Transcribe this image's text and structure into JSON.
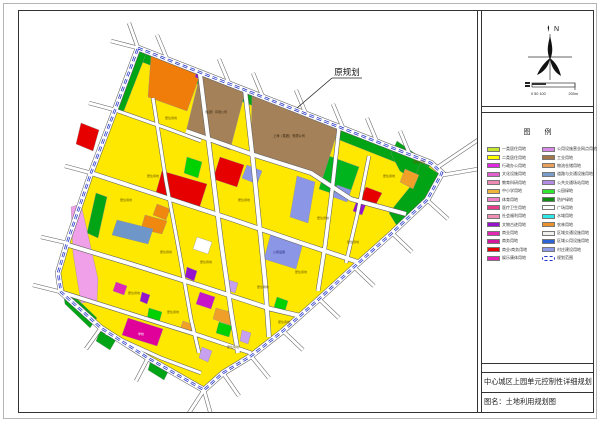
{
  "north_panel": {
    "north_label": "N",
    "scale_ticks": "0 50 100",
    "scale_end": "200m"
  },
  "legend": {
    "title": "图  例",
    "items": [
      {
        "color": "#c3e82e",
        "label": "一类居住用地"
      },
      {
        "color": "#ffff00",
        "label": "二类居住用地"
      },
      {
        "color": "#e028e0",
        "label": "行政办公用地"
      },
      {
        "color": "#e060d0",
        "label": "文化设施用地"
      },
      {
        "color": "#f08cb4",
        "label": "教育科研用地"
      },
      {
        "color": "#f0b43c",
        "label": "中小学用地"
      },
      {
        "color": "#f080c8",
        "label": "体育用地"
      },
      {
        "color": "#e63c8c",
        "label": "医疗卫生用地"
      },
      {
        "color": "#f090b4",
        "label": "社会福利用地"
      },
      {
        "color": "#9612cd",
        "label": "文物古迹用地"
      },
      {
        "color": "#e02ab4",
        "label": "商业用地"
      },
      {
        "color": "#d4189e",
        "label": "商务用地"
      },
      {
        "color": "#e60000",
        "label": "商业/商务用地"
      },
      {
        "color": "#eb1eb4",
        "label": "娱乐康体用地"
      },
      {
        "color": "#d98ae8",
        "label": "公用设施营业网点用地"
      },
      {
        "color": "#a5764a",
        "label": "工业用地"
      },
      {
        "color": "#e8a05a",
        "label": "物流仓储用地"
      },
      {
        "color": "#7a9cc8",
        "label": "道路与交通设施用地"
      },
      {
        "color": "#b48ce8",
        "label": "公共交通场站用地"
      },
      {
        "color": "#2ee82e",
        "label": "公园绿地"
      },
      {
        "color": "#0f8c0f",
        "label": "防护绿地"
      },
      {
        "color": "#ffffff",
        "label": "广场用地"
      },
      {
        "color": "#2ee8e8",
        "label": "水域用地"
      },
      {
        "color": "#e8922e",
        "label": "农林用地"
      },
      {
        "color": "#f0f0ee",
        "label": "区域交通设施用地"
      },
      {
        "color": "#2a64d4",
        "label": "区域公用设施用地"
      },
      {
        "color": "#8c9ce8",
        "label": "村庄建设用地"
      },
      {
        "boundary": true,
        "color": "#2030c8",
        "label": "规划范围"
      }
    ]
  },
  "title_block": {
    "line1": "中心城区上园单元控制性详细规划",
    "line2": "图名：土地利用规划图"
  },
  "map": {
    "annotation": {
      "text": "原规划",
      "tx": 346,
      "ty": 74,
      "underline": "331,77 361,77",
      "leader": "331,77 296,107"
    },
    "base_fill": "#ffe800",
    "boundary": {
      "color": "#2030c8",
      "points": "137,47 430,162 441,172 426,199 391,232 353,266 318,298 282,330 250,355 222,372 203,389 147,357 100,327 60,291 57,272 66,242 90,172 114,109"
    },
    "parcels": [
      {
        "p": "141,51 427,163 422,172 136,59",
        "f": "#00a414"
      },
      {
        "p": "137,50 145,53 122,112 114,108",
        "f": "#00a414"
      },
      {
        "p": "396,140 429,163 423,186 399,170 390,153",
        "f": "#00a414"
      },
      {
        "p": "420,161 438,173 424,197 396,225 388,212 409,186",
        "f": "#00a414"
      },
      {
        "p": "328,155 358,166 347,198 318,188",
        "f": "#00b41e"
      },
      {
        "p": "95,192 106,196 97,237 86,232",
        "f": "#00a414"
      },
      {
        "p": "62,291 73,295 96,317 89,327 64,303",
        "f": "#00a414"
      },
      {
        "p": "100,328 116,337 109,349 95,340",
        "f": "#00a414"
      },
      {
        "p": "150,358 169,367 163,379 147,369",
        "f": "#00a414"
      },
      {
        "p": "186,156 201,161 197,177 183,172",
        "f": "#00d200"
      },
      {
        "p": "148,307 161,311 158,322 146,318",
        "f": "#00d200"
      },
      {
        "p": "218,321 231,325 228,336 215,332",
        "f": "#00d200"
      },
      {
        "p": "276,296 287,300 284,310 273,306",
        "f": "#00d200"
      },
      {
        "p": "150,55 199,74 186,110 147,96",
        "f": "#f07d0a"
      },
      {
        "p": "199,74 244,91 229,149 185,131",
        "f": "#a5815a"
      },
      {
        "p": "251,92 338,126 322,176 285,163 250,150",
        "f": "#a5815a"
      },
      {
        "p": "144,214 166,220 161,233 140,228",
        "f": "#f0870f"
      },
      {
        "p": "156,203 169,208 165,219 152,214",
        "f": "#f0870f"
      },
      {
        "p": "404,168 418,174 412,188 399,181",
        "f": "#f0a028"
      },
      {
        "p": "215,307 233,312 229,324 212,318",
        "f": "#f0a028"
      },
      {
        "p": "182,320 193,324 190,333 179,329",
        "f": "#f0a028"
      },
      {
        "p": "80,122 98,129 92,150 75,143",
        "f": "#e60000"
      },
      {
        "p": "161,170 206,183 198,208 154,195",
        "f": "#e60000"
      },
      {
        "p": "219,156 243,164 236,186 212,178",
        "f": "#e60000"
      },
      {
        "p": "365,186 381,192 374,205 359,199",
        "f": "#e60000"
      },
      {
        "p": "246,164 261,170 256,183 241,177",
        "f": "#8c96e6"
      },
      {
        "p": "296,175 314,181 307,222 289,216",
        "f": "#8c96e6"
      },
      {
        "p": "270,232 302,242 295,268 263,258",
        "f": "#8c96e6"
      },
      {
        "p": "336,184 350,189 346,201 332,196",
        "f": "#8c96e6"
      },
      {
        "p": "116,219 152,228 147,243 111,234",
        "f": "#6e96c8"
      },
      {
        "p": "196,69 203,72 200,79 194,76",
        "f": "#9613cd"
      },
      {
        "p": "356,199 365,203 361,214 352,210",
        "f": "#9613cd"
      },
      {
        "p": "186,266 196,270 193,280 184,276",
        "f": "#9613cd"
      },
      {
        "p": "141,291 149,294 146,303 139,300",
        "f": "#9613cd"
      },
      {
        "p": "228,279 237,282 234,292 226,289",
        "f": "#c8a0f0"
      },
      {
        "p": "201,346 211,350 207,361 198,357",
        "f": "#c8a0f0"
      },
      {
        "p": "241,329 250,332 247,343 239,340",
        "f": "#c8a0f0"
      },
      {
        "p": "127,317 162,328 156,345 121,334",
        "f": "#e0009a"
      },
      {
        "p": "199,291 214,296 210,308 195,303",
        "f": "#c814c8"
      },
      {
        "p": "115,281 126,285 123,294 112,290",
        "f": "#e028b4"
      },
      {
        "p": "196,236 211,241 207,253 192,248",
        "f": "#ffffff"
      },
      {
        "p": "70,206 80,203 97,278 96,300 80,302 72,252",
        "f": "#f0a0e8"
      }
    ],
    "roads": [
      {
        "p": "152,97 165,180 178,250 190,318 198,352",
        "w": 3
      },
      {
        "p": "199,73 210,160 220,240 230,310 237,352",
        "w": 4
      },
      {
        "p": "244,89 252,160 258,220 264,280 268,336",
        "w": 4
      },
      {
        "p": "338,127 331,190 324,245 317,290",
        "w": 3.5
      },
      {
        "p": "368,155 356,215 345,262",
        "w": 3
      },
      {
        "p": "114,109 165,127 200,140",
        "w": 3
      },
      {
        "p": "185,130 250,153 310,172 350,198 405,213",
        "w": 4
      },
      {
        "p": "90,172 160,195 230,218 300,242 360,262",
        "w": 4
      },
      {
        "p": "64,243 130,263 200,285 270,308 300,315",
        "w": 4
      },
      {
        "p": "60,291 130,313 200,335 250,352",
        "w": 3.5
      },
      {
        "p": "105,332 160,357 200,372",
        "w": 3
      }
    ],
    "stubs": [
      "166,58 156,34",
      "228,82 218,58",
      "262,96 252,72",
      "305,113 295,89",
      "342,127 332,103",
      "376,141 366,117",
      "409,154 399,130",
      "437,166 477,139",
      "442,174 477,168",
      "426,199 447,218",
      "391,232 411,251",
      "353,266 373,285",
      "318,298 338,317",
      "282,330 302,349",
      "250,355 268,377",
      "222,372 238,395",
      "203,389 210,414",
      "203,389 188,412",
      "147,357 135,380",
      "100,327 85,348",
      "60,291 32,284",
      "66,242 40,236",
      "90,172 64,165",
      "114,109 88,102",
      "137,47 128,22",
      "137,47 110,40"
    ],
    "labels": [
      {
        "x": 288,
        "y": 136,
        "t": "上海（集团）有限公司",
        "c": "#3a2a10",
        "s": 3.2
      },
      {
        "x": 214,
        "y": 112,
        "t": "（集团）有限公司",
        "c": "#3a2a10",
        "s": 3
      },
      {
        "x": 170,
        "y": 118,
        "t": "居住用地",
        "c": "#6b5a00",
        "s": 3
      },
      {
        "x": 125,
        "y": 200,
        "t": "居住用地",
        "c": "#6b5a00",
        "s": 3
      },
      {
        "x": 152,
        "y": 176,
        "t": "居住用地",
        "c": "#6b5a00",
        "s": 3
      },
      {
        "x": 243,
        "y": 200,
        "t": "居住用地",
        "c": "#6b5a00",
        "s": 3
      },
      {
        "x": 322,
        "y": 218,
        "t": "居住用地",
        "c": "#6b5a00",
        "s": 3
      },
      {
        "x": 388,
        "y": 176,
        "t": "居住用地",
        "c": "#6b5a00",
        "s": 3
      },
      {
        "x": 418,
        "y": 162,
        "t": "居住用地",
        "c": "#6b5a00",
        "s": 3
      },
      {
        "x": 165,
        "y": 252,
        "t": "居住用地",
        "c": "#6b5a00",
        "s": 3
      },
      {
        "x": 205,
        "y": 262,
        "t": "居住用地",
        "c": "#6b5a00",
        "s": 3
      },
      {
        "x": 262,
        "y": 287,
        "t": "居住用地",
        "c": "#6b5a00",
        "s": 3
      },
      {
        "x": 133,
        "y": 293,
        "t": "居住用地",
        "c": "#6b5a00",
        "s": 3
      },
      {
        "x": 172,
        "y": 312,
        "t": "居住用地",
        "c": "#6b5a00",
        "s": 3
      },
      {
        "x": 232,
        "y": 347,
        "t": "居住用地",
        "c": "#6b5a00",
        "s": 3
      },
      {
        "x": 283,
        "y": 322,
        "t": "居住用地",
        "c": "#6b5a00",
        "s": 3
      },
      {
        "x": 352,
        "y": 242,
        "t": "居住用地",
        "c": "#6b5a00",
        "s": 3
      },
      {
        "x": 300,
        "y": 272,
        "t": "居住用地",
        "c": "#6b5a00",
        "s": 3
      },
      {
        "x": 140,
        "y": 334,
        "t": "学校",
        "c": "#ffffff",
        "s": 3
      },
      {
        "x": 278,
        "y": 252,
        "t": "公用设施",
        "c": "#20256e",
        "s": 3
      }
    ]
  }
}
